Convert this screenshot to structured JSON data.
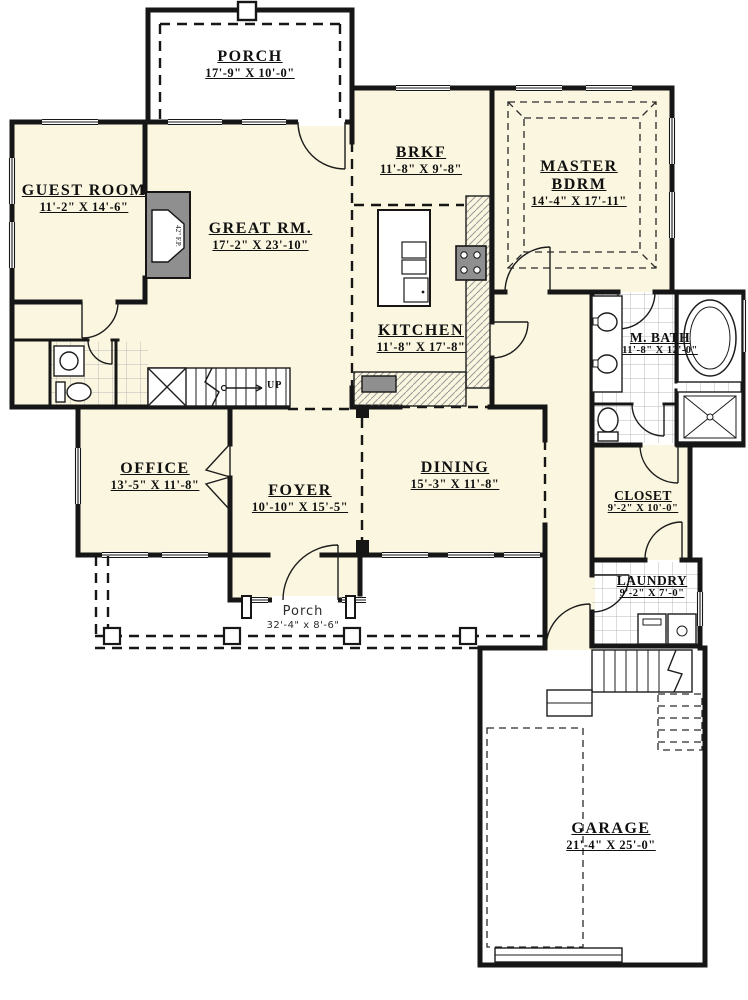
{
  "plan": {
    "rooms": [
      {
        "id": "porch-top",
        "name": "PORCH",
        "dims": "17'-9\" X 10'-0\""
      },
      {
        "id": "guest-room",
        "name": "GUEST ROOM",
        "dims": "11'-2\" X 14'-6\""
      },
      {
        "id": "great-room",
        "name": "GREAT RM.",
        "dims": "17'-2\" X 23'-10\""
      },
      {
        "id": "breakfast",
        "name": "BRKF",
        "dims": "11'-8\" X 9'-8\""
      },
      {
        "id": "master-bdrm",
        "name": "MASTER BDRM",
        "dims": "14'-4\" X 17'-11\""
      },
      {
        "id": "kitchen",
        "name": "KITCHEN",
        "dims": "11'-8\" X 17'-8\""
      },
      {
        "id": "master-bath",
        "name": "M. BATH",
        "dims": "11'-8\" X 12'-0\""
      },
      {
        "id": "office",
        "name": "OFFICE",
        "dims": "13'-5\" X 11'-8\""
      },
      {
        "id": "foyer",
        "name": "FOYER",
        "dims": "10'-10\" X 15'-5\""
      },
      {
        "id": "dining",
        "name": "DINING",
        "dims": "15'-3\" X 11'-8\""
      },
      {
        "id": "closet",
        "name": "CLOSET",
        "dims": "9'-2\" X 10'-0\""
      },
      {
        "id": "laundry",
        "name": "LAUNDRY",
        "dims": "9'-2\" X 7'-0\""
      },
      {
        "id": "porch-bottom",
        "name": "Porch",
        "dims": "32'-4\" x 8'-6\""
      },
      {
        "id": "garage",
        "name": "GARAGE",
        "dims": "21'-4\" X 25'-0\""
      }
    ],
    "annotations": {
      "stairs_up": "UP",
      "fireplace": "42\" F.P."
    },
    "colors": {
      "floor": "#FAF6DF",
      "wall": "#161616",
      "paper": "#FFFFFF",
      "fixture_gray": "#8F8F8F"
    }
  }
}
